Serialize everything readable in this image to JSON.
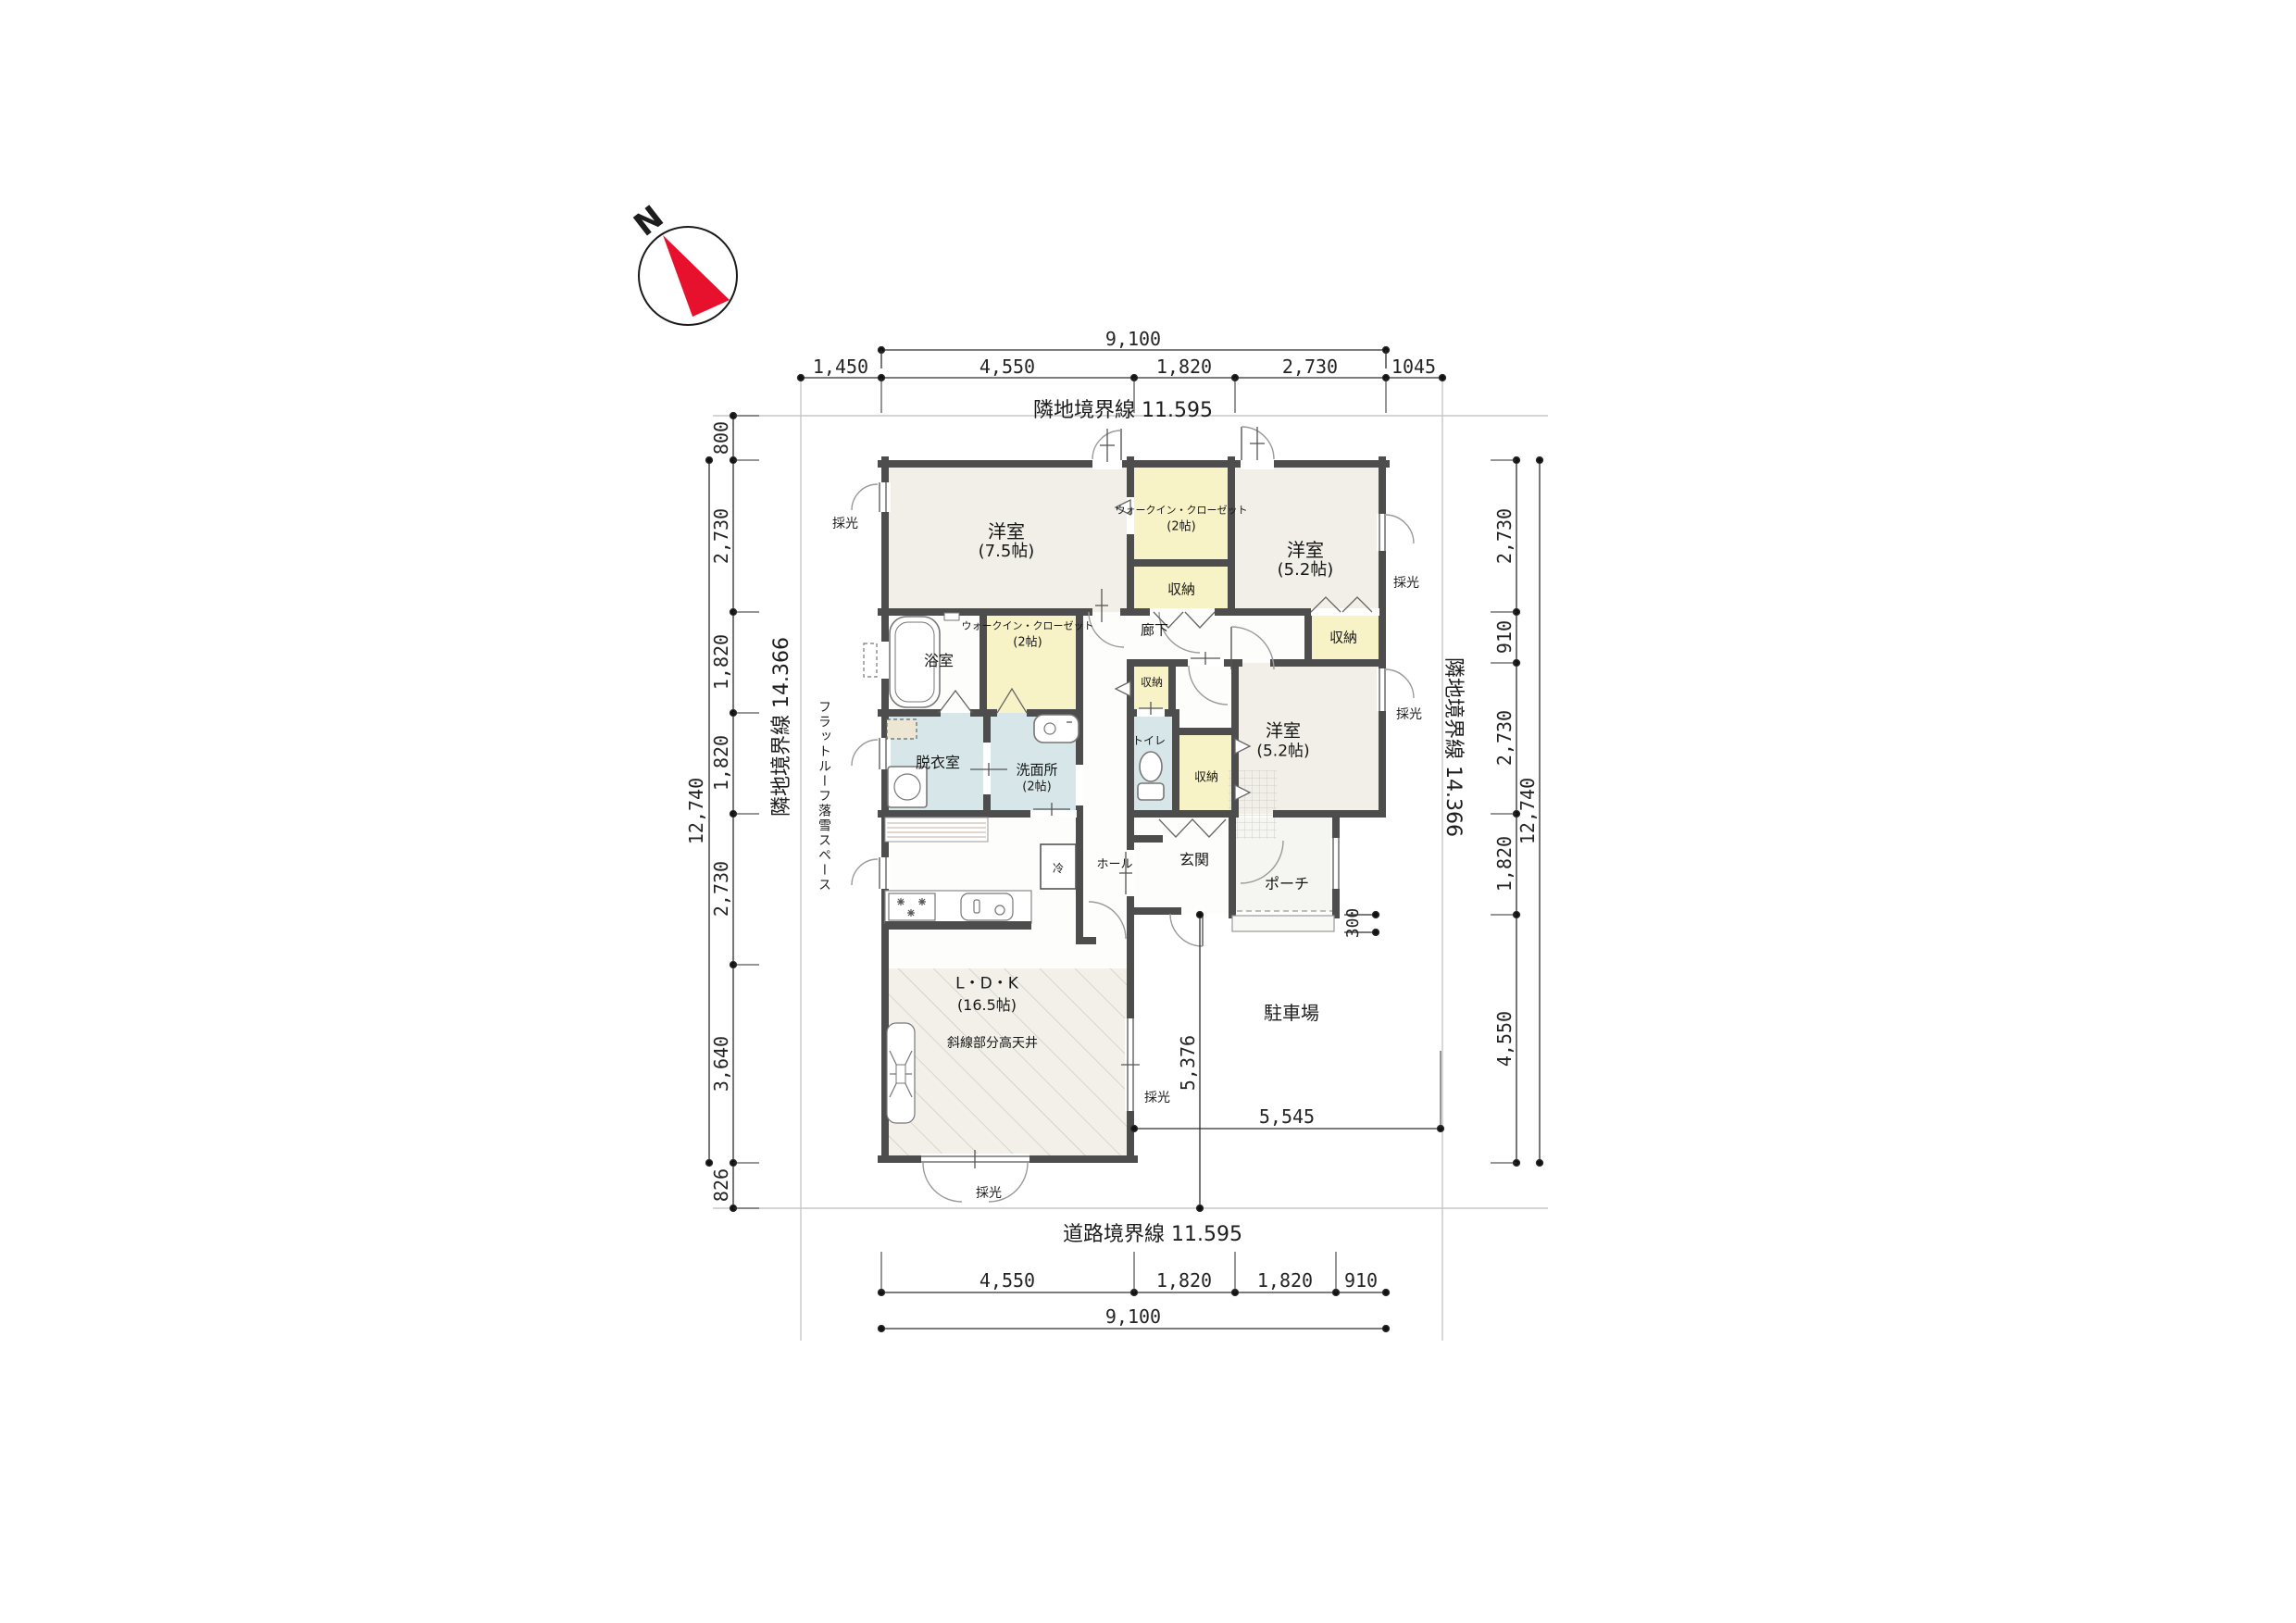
{
  "compass": {
    "north_label": "N"
  },
  "site": {
    "boundary_top": "隣地境界線 11.595",
    "boundary_bottom": "道路境界線 11.595",
    "boundary_left": "隣地境界線 14.366",
    "boundary_right": "隣地境界線 14.366",
    "flat_roof_note": "フラットルーフ落雪スペース",
    "parking": "駐車場"
  },
  "dimensions": {
    "top": {
      "total": "9,100",
      "segments": [
        "1,450",
        "4,550",
        "1,820",
        "2,730",
        "1045"
      ]
    },
    "bottom": {
      "total": "9,100",
      "segments": [
        "4,550",
        "1,820",
        "1,820",
        "910"
      ]
    },
    "left": {
      "total": "12,740",
      "segments": [
        "800",
        "2,730",
        "1,820",
        "1,820",
        "2,730",
        "3,640",
        "826"
      ]
    },
    "right": {
      "total": "12,740",
      "segments": [
        "2,730",
        "910",
        "2,730",
        "1,820",
        "4,550"
      ]
    },
    "site_width": "5,545",
    "site_depth": "5,376",
    "porch_step": "300"
  },
  "rooms": {
    "bedroom_75": {
      "name": "洋室",
      "size": "(7.5帖)"
    },
    "wic_north": {
      "name": "ウォークイン・クローゼット",
      "size": "(2帖)"
    },
    "closet_north": {
      "name": "収納"
    },
    "bedroom_52_ne": {
      "name": "洋室",
      "size": "(5.2帖)"
    },
    "closet_ne": {
      "name": "収納"
    },
    "corridor": {
      "name": "廊下"
    },
    "bathroom": {
      "name": "浴室"
    },
    "wic_center": {
      "name": "ウォークイン・クローゼット",
      "size": "(2帖)"
    },
    "dressing": {
      "name": "脱衣室"
    },
    "washroom": {
      "name": "洗面所",
      "size": "(2帖)"
    },
    "toilet": {
      "name": "トイレ"
    },
    "closet_small": {
      "name": "収納"
    },
    "closet_center": {
      "name": "収納"
    },
    "bedroom_52_e": {
      "name": "洋室",
      "size": "(5.2帖)"
    },
    "hall": {
      "name": "ホール"
    },
    "entrance": {
      "name": "玄関"
    },
    "porch": {
      "name": "ポーチ"
    },
    "ldk": {
      "name": "L・D・K",
      "size": "(16.5帖)"
    }
  },
  "annotations": {
    "daylight": "採光",
    "high_ceiling": "斜線部分高天井",
    "fridge": "冷"
  }
}
